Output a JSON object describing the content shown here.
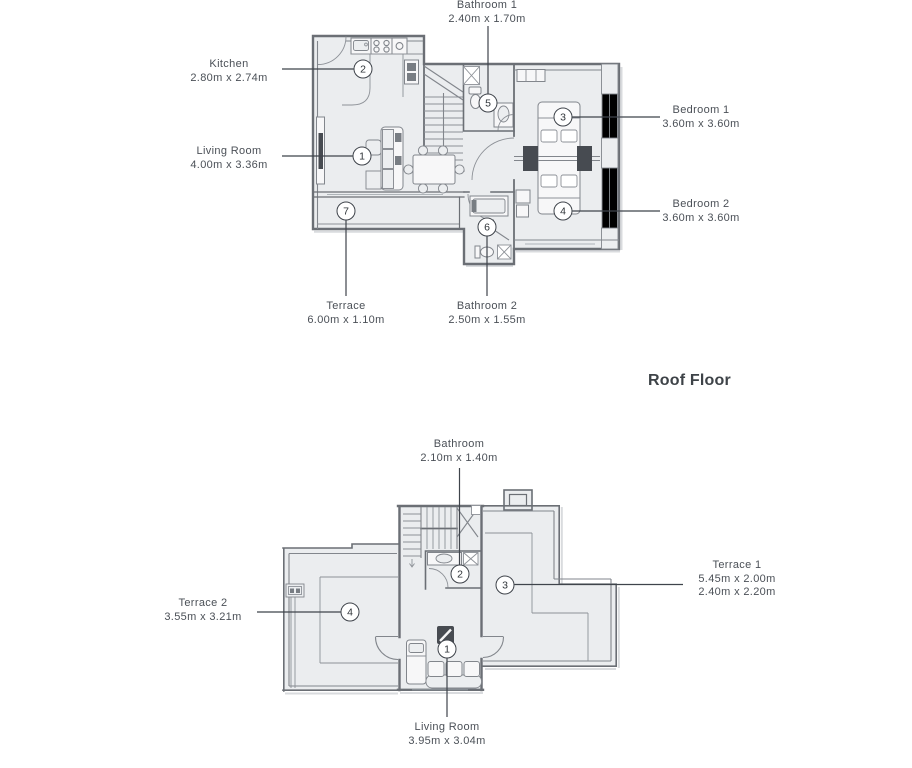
{
  "floor1": {
    "labels": {
      "bathroom1": {
        "title": "Bathroom 1",
        "dims": "2.40m x 1.70m"
      },
      "kitchen": {
        "title": "Kitchen",
        "dims": "2.80m x 2.74m"
      },
      "living": {
        "title": "Living Room",
        "dims": "4.00m x 3.36m"
      },
      "bedroom1": {
        "title": "Bedroom 1",
        "dims": "3.60m x 3.60m"
      },
      "bedroom2": {
        "title": "Bedroom 2",
        "dims": "3.60m x 3.60m"
      },
      "terrace": {
        "title": "Terrace",
        "dims": "6.00m x 1.10m"
      },
      "bathroom2": {
        "title": "Bathroom 2",
        "dims": "2.50m x 1.55m"
      }
    },
    "markers": {
      "living": "1",
      "kitchen": "2",
      "bedroom1": "3",
      "bedroom2": "4",
      "bathroom1": "5",
      "bathroom2": "6",
      "terrace": "7"
    }
  },
  "roof": {
    "section_title": "Roof Floor",
    "labels": {
      "bathroom": {
        "title": "Bathroom",
        "dims": "2.10m x 1.40m"
      },
      "terrace1": {
        "title": "Terrace 1",
        "dims": "5.45m x 2.00m",
        "dims2": "2.40m x 2.20m"
      },
      "terrace2": {
        "title": "Terrace 2",
        "dims": "3.55m x 3.21m"
      },
      "living": {
        "title": "Living Room",
        "dims": "3.95m x 3.04m"
      }
    },
    "markers": {
      "living": "1",
      "bathroom": "2",
      "terrace1": "3",
      "terrace2": "4"
    }
  },
  "colors": {
    "wall": "#6b6f75",
    "floor": "#ebedef",
    "leader": "#3f444b",
    "label_text": "#4b5057",
    "poche": "#474b51"
  }
}
